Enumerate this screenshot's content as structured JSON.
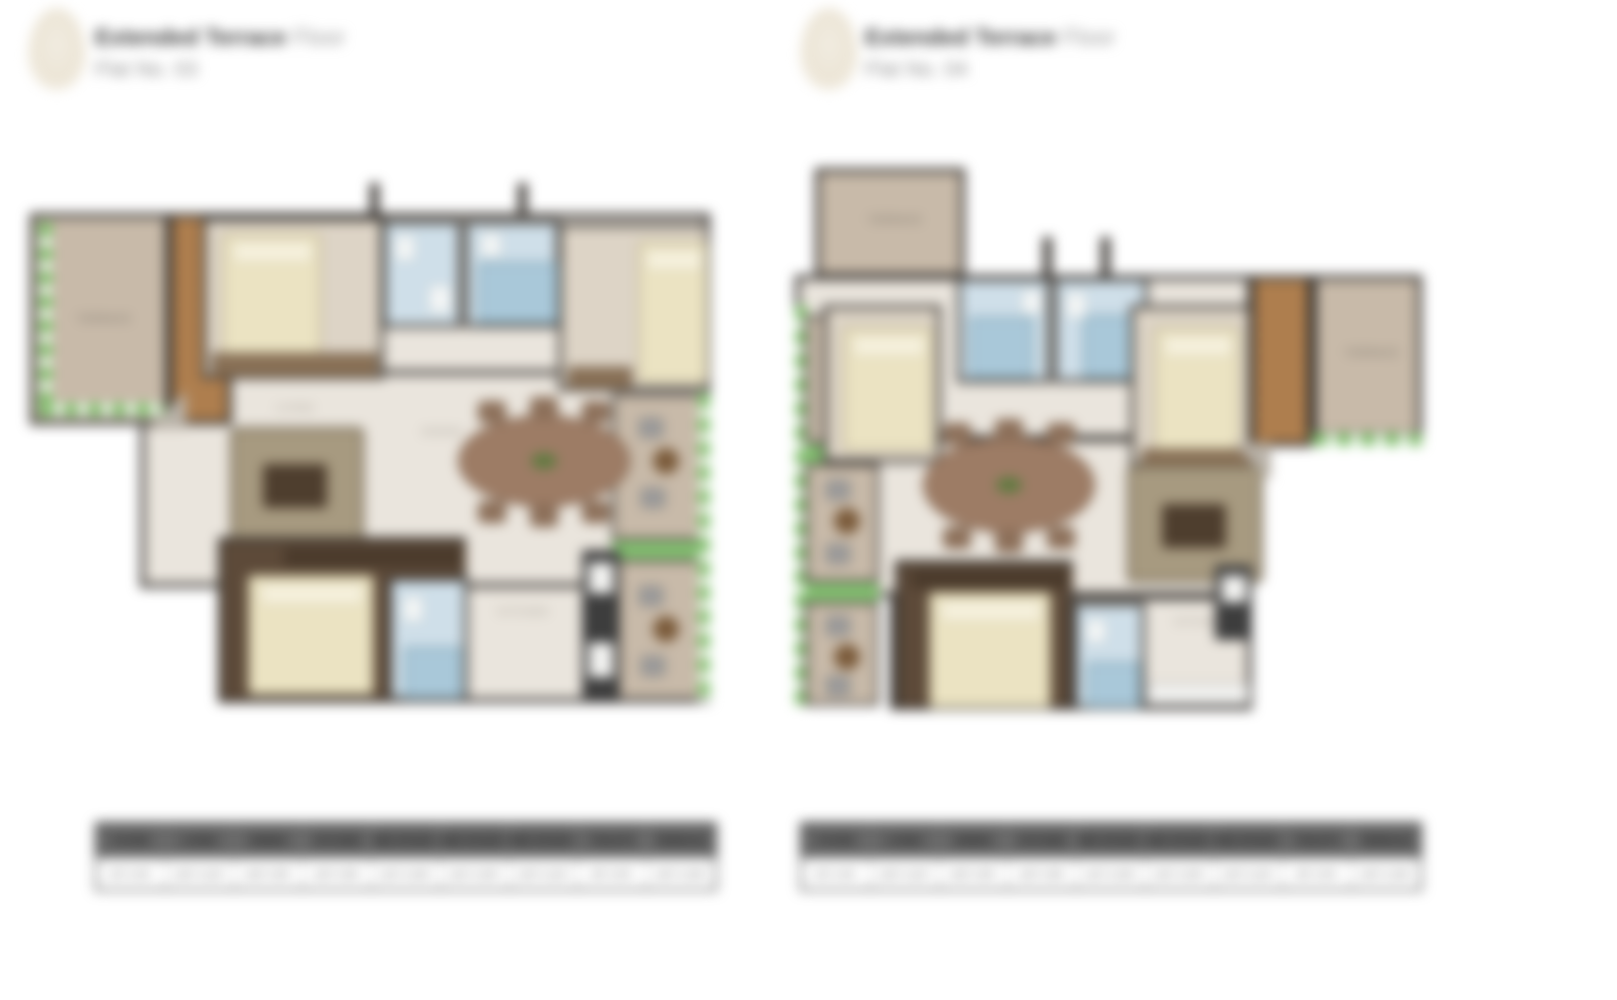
{
  "colors": {
    "wall": "#3b3733",
    "floorMain": "#eae5dd",
    "terrace": "#c8baa9",
    "deck": "#b08050",
    "bedFloor": "#ddd4c6",
    "masterFloor": "#5d4a39",
    "bedCream": "#ebe3c2",
    "bath": "#cfdfe9",
    "bathDeep": "#a9c8d9",
    "balGreen": "#85c272",
    "sofa": "#a79a80",
    "sofaDark": "#4e3e2e",
    "dining": "#9d7c65"
  },
  "plans": [
    {
      "title_bold": "Extended Terrace",
      "title_light": "Floor",
      "flat_no": "Flat No. 03",
      "room_labels": {
        "terrace": "TERRACE",
        "living": "LIVING",
        "dining": "DINING",
        "kitchen": "KITCHEN",
        "balcony": "BALCONY"
      }
    },
    {
      "title_bold": "Extended Terrace",
      "title_light": "Floor",
      "flat_no": "Flat No. 04",
      "room_labels": {
        "terrace": "TERRACE",
        "living": "LIVING",
        "dining": "DINING",
        "kitchen": "KITCHEN",
        "balcony": "BALCONY"
      }
    }
  ],
  "schedule": {
    "headers": [
      "FOYER",
      "LIVING",
      "DINING",
      "KITCHEN",
      "BED ROOM 1",
      "BED ROOM 2",
      "BED ROOM 3",
      "TOILETS",
      "TERRACE"
    ],
    "values": [
      "6'0\" X 4'6\"",
      "12'6\" X 11'0\"",
      "10'6\" X 8'0\"",
      "10'0\" X 8'6\"",
      "11'0\" X 10'6\"",
      "11'6\" X 10'0\"",
      "12'0\" X 11'0\"",
      "8'0\" X 5'0\"",
      "14'0\" X 10'6\""
    ]
  }
}
